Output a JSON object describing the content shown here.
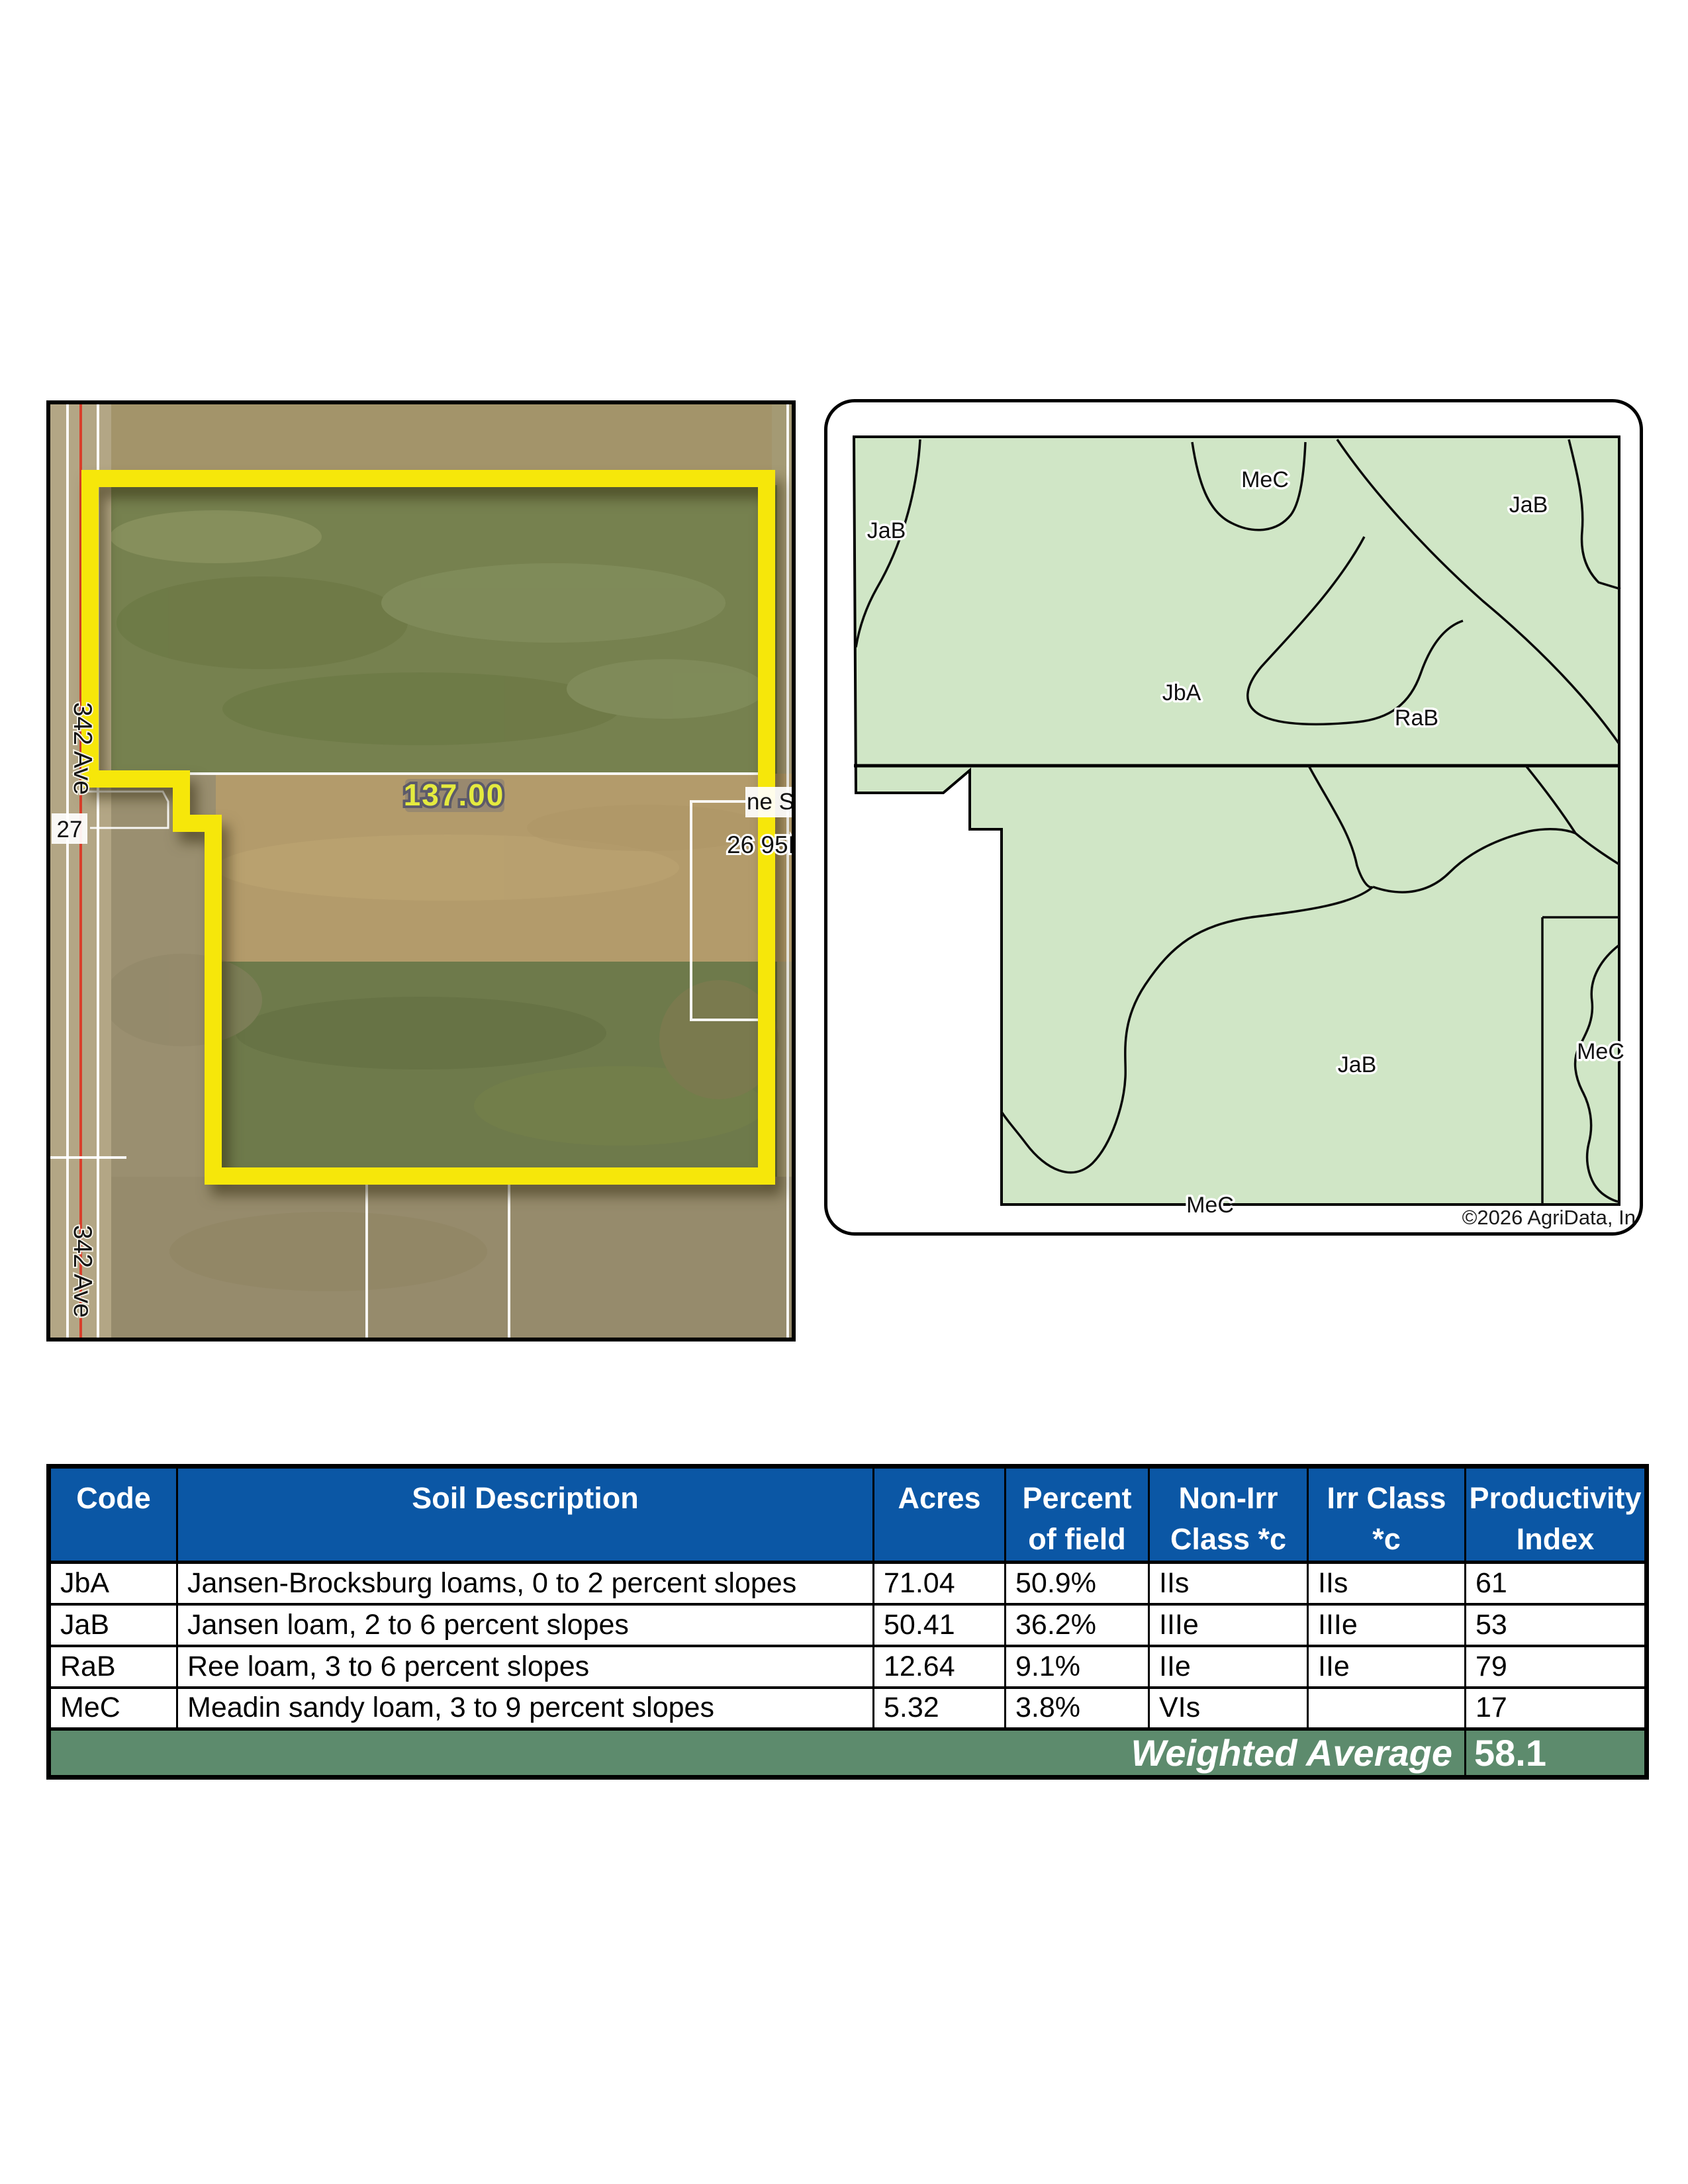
{
  "aerial": {
    "field_acres_label": "137.00",
    "road_label_top": "342 Ave",
    "road_label_bottom": "342 Ave",
    "route_label": "27",
    "edge_label_1": "ne S",
    "edge_label_2": "26 95N-7",
    "boundary_color": "#f6e70a"
  },
  "soilmap": {
    "fill": "#d0e6c6",
    "labels": [
      {
        "text": "JaB"
      },
      {
        "text": "MeC"
      },
      {
        "text": "JaB"
      },
      {
        "text": "JbA"
      },
      {
        "text": "RaB"
      },
      {
        "text": "JaB"
      },
      {
        "text": "MeC"
      },
      {
        "text": "MeC"
      }
    ],
    "copyright": "©2026 AgriData, In"
  },
  "table": {
    "header_bg": "#0b57a5",
    "footer_bg": "#5d8b6d",
    "columns": [
      "Code",
      "Soil Description",
      "Acres",
      "Percent\nof field",
      "Non-Irr\nClass *c",
      "Irr Class\n*c",
      "Productivity\nIndex"
    ],
    "rows": [
      [
        "JbA",
        "Jansen-Brocksburg loams, 0 to 2 percent slopes",
        "71.04",
        "50.9%",
        "IIs",
        "IIs",
        "61"
      ],
      [
        "JaB",
        "Jansen loam, 2 to 6 percent slopes",
        "50.41",
        "36.2%",
        "IIIe",
        "IIIe",
        "53"
      ],
      [
        "RaB",
        "Ree loam, 3 to 6 percent slopes",
        "12.64",
        "9.1%",
        "IIe",
        "IIe",
        "79"
      ],
      [
        "MeC",
        "Meadin sandy loam, 3 to 9 percent slopes",
        "5.32",
        "3.8%",
        "VIs",
        "",
        "17"
      ]
    ],
    "footer": {
      "label": "Weighted Average",
      "value": "58.1"
    }
  }
}
